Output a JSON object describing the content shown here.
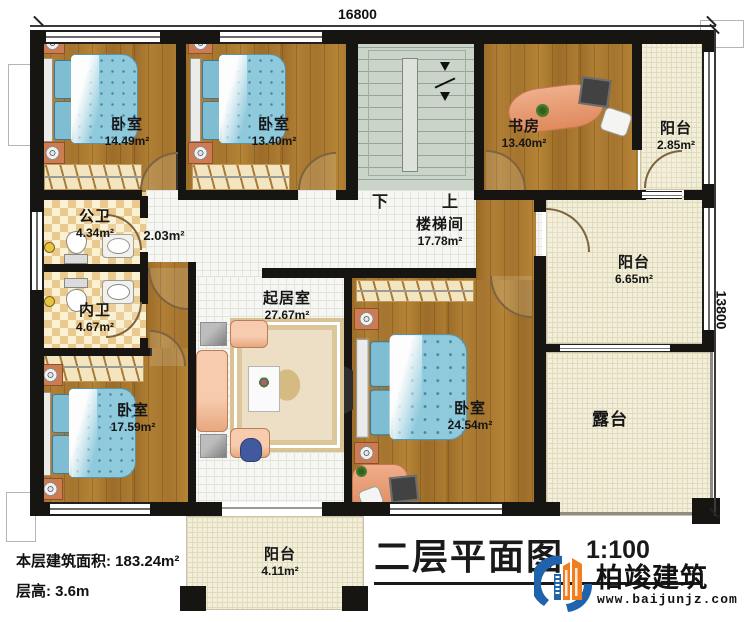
{
  "dimensions": {
    "width_label": "16800",
    "height_label": "13800"
  },
  "rooms": {
    "bedroom1": {
      "name": "卧室",
      "area": "14.49m²"
    },
    "bedroom2": {
      "name": "卧室",
      "area": "13.40m²"
    },
    "study": {
      "name": "书房",
      "area": "13.40m²"
    },
    "balcony_top": {
      "name": "阳台",
      "area": "2.85m²"
    },
    "public_bath": {
      "name": "公卫",
      "area": "4.34m²"
    },
    "hallway": {
      "area": "2.03m²"
    },
    "stairwell": {
      "name": "楼梯间",
      "area": "17.78m²"
    },
    "balcony_right": {
      "name": "阳台",
      "area": "6.65m²"
    },
    "private_bath": {
      "name": "内卫",
      "area": "4.67m²"
    },
    "living": {
      "name": "起居室",
      "area": "27.67m²"
    },
    "bedroom3": {
      "name": "卧室",
      "area": "17.59m²"
    },
    "bedroom4": {
      "name": "卧室",
      "area": "24.54m²"
    },
    "terrace": {
      "name": "露台"
    },
    "balcony_bottom": {
      "name": "阳台",
      "area": "4.11m²"
    }
  },
  "stairs": {
    "down_label": "下",
    "up_label": "上"
  },
  "footer": {
    "floor_area": "本层建筑面积: 183.24m²",
    "floor_height": "层高: 3.6m",
    "title": "二层平面图",
    "scale": "1:100",
    "brand": "柏竣建筑",
    "website": "www.baijunjz.com"
  },
  "colors": {
    "wall": "#171512",
    "wood_floor": "#a87730",
    "tile_floor": "#f6f6f3",
    "balcony_floor": "#f2eeda",
    "stair_floor": "#cbd4c9",
    "bed_blue": "#8ec9dc",
    "logo_blue": "#1f63ad",
    "logo_orange": "#f07e1e"
  }
}
